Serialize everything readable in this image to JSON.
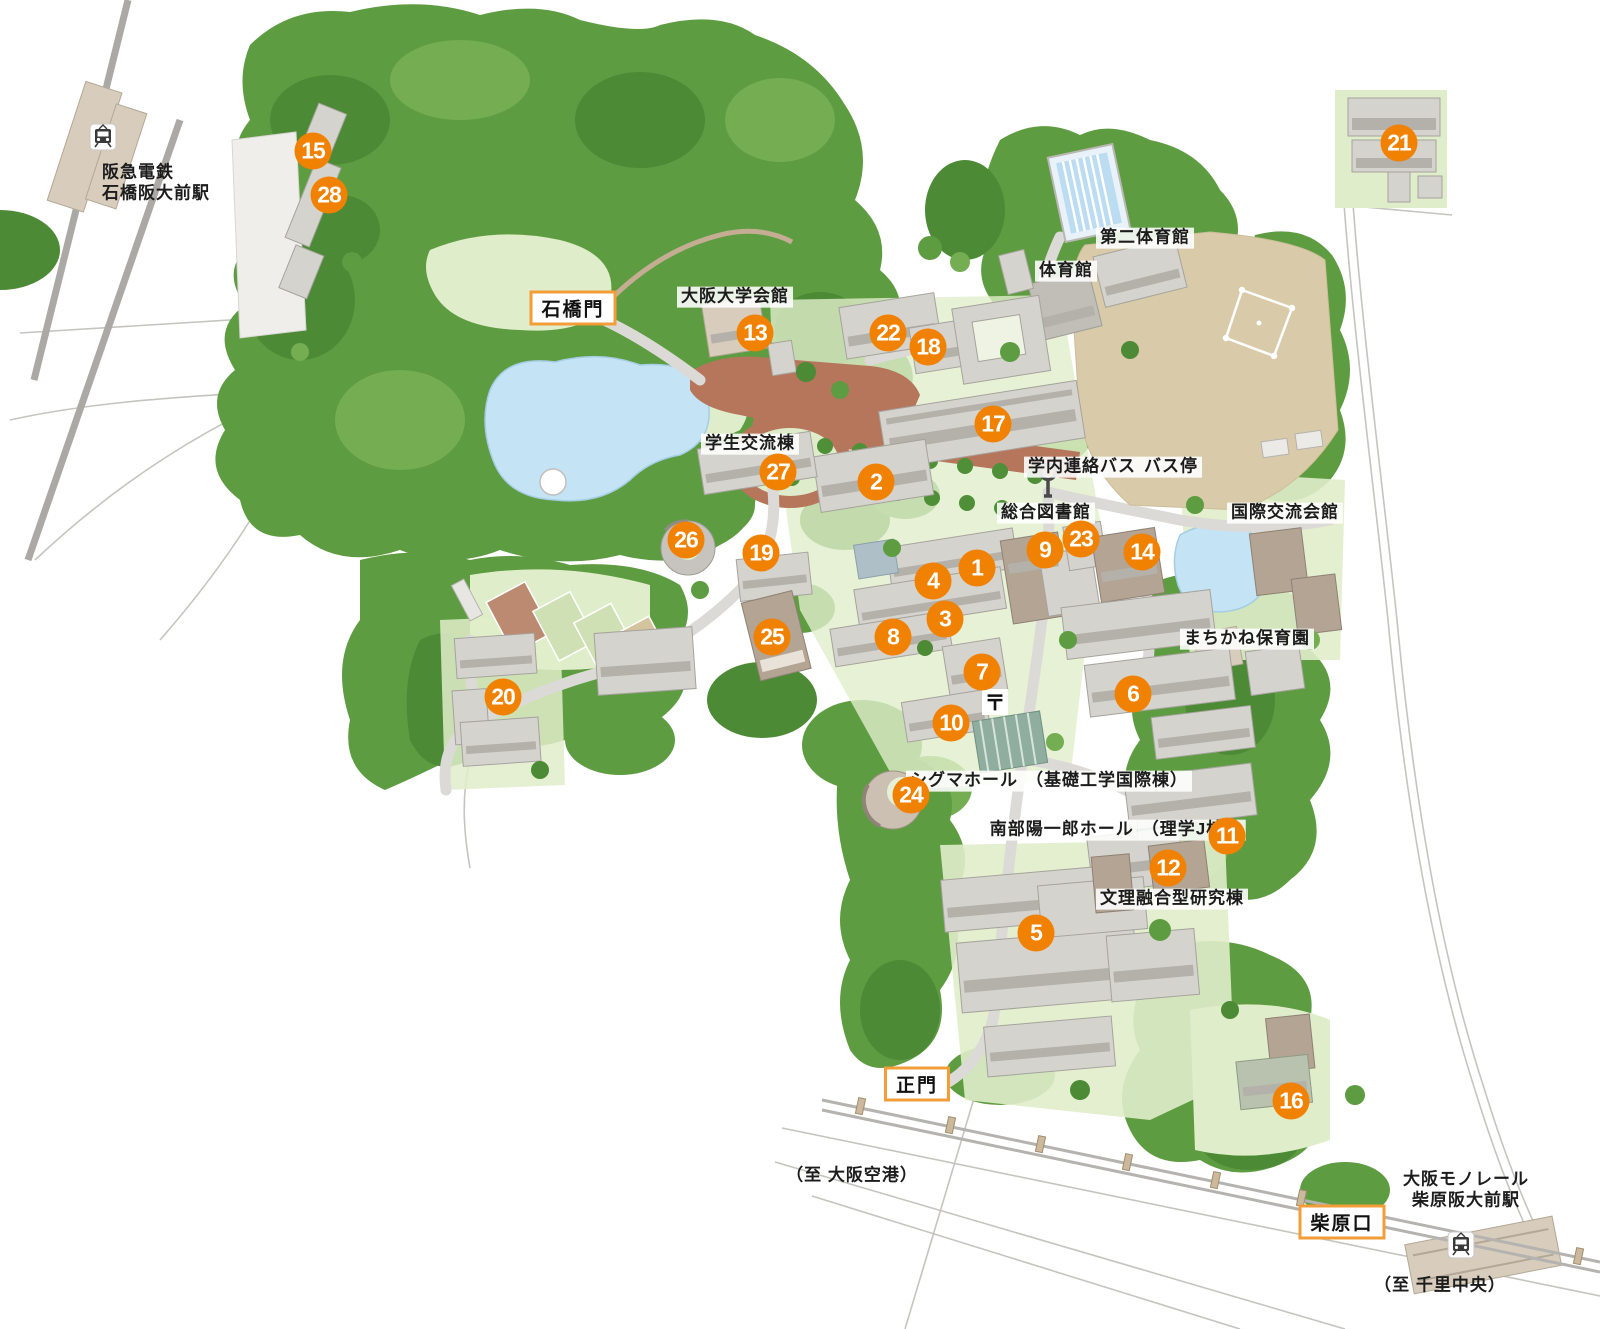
{
  "map_markers": [
    {
      "number": 1,
      "x": 977,
      "y": 568
    },
    {
      "number": 2,
      "x": 876,
      "y": 482
    },
    {
      "number": 3,
      "x": 945,
      "y": 619
    },
    {
      "number": 4,
      "x": 933,
      "y": 581
    },
    {
      "number": 5,
      "x": 1036,
      "y": 933
    },
    {
      "number": 6,
      "x": 1133,
      "y": 694
    },
    {
      "number": 7,
      "x": 982,
      "y": 672
    },
    {
      "number": 8,
      "x": 893,
      "y": 637
    },
    {
      "number": 9,
      "x": 1045,
      "y": 550
    },
    {
      "number": 10,
      "x": 951,
      "y": 723
    },
    {
      "number": 11,
      "x": 1227,
      "y": 836
    },
    {
      "number": 12,
      "x": 1168,
      "y": 868
    },
    {
      "number": 13,
      "x": 755,
      "y": 333
    },
    {
      "number": 14,
      "x": 1142,
      "y": 552
    },
    {
      "number": 15,
      "x": 313,
      "y": 151
    },
    {
      "number": 16,
      "x": 1291,
      "y": 1101
    },
    {
      "number": 17,
      "x": 993,
      "y": 424
    },
    {
      "number": 18,
      "x": 928,
      "y": 347
    },
    {
      "number": 19,
      "x": 761,
      "y": 553
    },
    {
      "number": 20,
      "x": 503,
      "y": 697
    },
    {
      "number": 21,
      "x": 1399,
      "y": 143
    },
    {
      "number": 22,
      "x": 888,
      "y": 333
    },
    {
      "number": 23,
      "x": 1081,
      "y": 539
    },
    {
      "number": 24,
      "x": 911,
      "y": 795
    },
    {
      "number": 25,
      "x": 772,
      "y": 637
    },
    {
      "number": 26,
      "x": 686,
      "y": 540
    },
    {
      "number": 27,
      "x": 778,
      "y": 472
    },
    {
      "number": 28,
      "x": 329,
      "y": 195
    }
  ],
  "gate_labels": [
    {
      "id": "ishibashi",
      "label": "石橋門",
      "x": 573,
      "y": 308
    },
    {
      "id": "main",
      "label": "正門",
      "x": 917,
      "y": 1084
    },
    {
      "id": "shibahara",
      "label": "柴原口",
      "x": 1342,
      "y": 1222
    }
  ],
  "place_labels": [
    {
      "id": "hankyu-station",
      "lines": [
        "阪急電鉄",
        "石橋阪大前駅"
      ],
      "x": 102,
      "y": 183,
      "boxed": false,
      "align": "left"
    },
    {
      "id": "osaka-univ-hall",
      "lines": [
        "大阪大学会館"
      ],
      "x": 735,
      "y": 297,
      "boxed": true,
      "align": "center"
    },
    {
      "id": "student-exchange-bldg",
      "lines": [
        "学生交流棟"
      ],
      "x": 750,
      "y": 444,
      "boxed": true,
      "align": "center"
    },
    {
      "id": "gym",
      "lines": [
        "体育館"
      ],
      "x": 1066,
      "y": 271,
      "boxed": true,
      "align": "center"
    },
    {
      "id": "gym2",
      "lines": [
        "第二体育館"
      ],
      "x": 1145,
      "y": 238,
      "boxed": true,
      "align": "center"
    },
    {
      "id": "shuttle-bus-stop",
      "lines": [
        "学内連絡バス",
        "バス停"
      ],
      "x": 1113,
      "y": 467,
      "boxed": true,
      "align": "center"
    },
    {
      "id": "main-library",
      "lines": [
        "総合図書館"
      ],
      "x": 1046,
      "y": 513,
      "boxed": true,
      "align": "center"
    },
    {
      "id": "intl-house",
      "lines": [
        "国際交流会館"
      ],
      "x": 1285,
      "y": 513,
      "boxed": true,
      "align": "center"
    },
    {
      "id": "machikane-nursery",
      "lines": [
        "まちかね保育園"
      ],
      "x": 1247,
      "y": 639,
      "boxed": true,
      "align": "center"
    },
    {
      "id": "sigma-hall",
      "lines": [
        "シグマホール",
        "（基礎工学国際棟）"
      ],
      "x": 1049,
      "y": 781,
      "boxed": true,
      "align": "center"
    },
    {
      "id": "nambu-hall",
      "lines": [
        "南部陽一郎ホール",
        "（理学J棟）"
      ],
      "x": 1116,
      "y": 830,
      "boxed": true,
      "align": "center"
    },
    {
      "id": "bunri-research-bldg",
      "lines": [
        "文理融合型研究棟"
      ],
      "x": 1172,
      "y": 899,
      "boxed": true,
      "align": "center"
    },
    {
      "id": "to-osaka-airport",
      "lines": [
        "（至 大阪空港）"
      ],
      "x": 852,
      "y": 1176,
      "boxed": false,
      "align": "center"
    },
    {
      "id": "monorail-station",
      "lines": [
        "大阪モノレール",
        "柴原阪大前駅"
      ],
      "x": 1466,
      "y": 1190,
      "boxed": false,
      "align": "center"
    },
    {
      "id": "to-senri-chuo",
      "lines": [
        "（至 千里中央）"
      ],
      "x": 1440,
      "y": 1286,
      "boxed": false,
      "align": "center"
    }
  ],
  "icons": {
    "postal_symbol": "〒",
    "bus_stop": "bus-stop-icon",
    "hankyu_train": "train-icon",
    "monorail_train": "train-icon"
  },
  "colors": {
    "marker_bg": "#f18101",
    "gate_border": "#f29d38",
    "forest_green": "#5e9c41",
    "water_blue": "#c4e3f5",
    "field_tan": "#d9cbaa",
    "plaza_brick": "#b5765c"
  }
}
